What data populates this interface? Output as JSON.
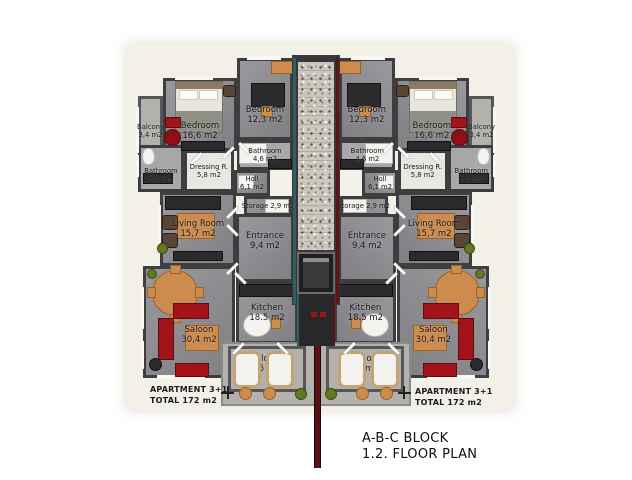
{
  "title_block": {
    "line1": "A-B-C BLOCK",
    "line2": "1.2. FLOOR PLAN"
  },
  "apartments": {
    "left": {
      "summary": {
        "line1": "APARTMENT 3+1",
        "line2": "TOTAL 172 m2"
      },
      "rooms": {
        "balcony_side": {
          "label": "Balcony",
          "area": "3,4 m2"
        },
        "bedroom_large": {
          "label": "Bedroom",
          "area": "16,6 m2"
        },
        "bedroom_small": {
          "label": "Bedroom",
          "area": "12,3 m2"
        },
        "bathroom_large": {
          "label": "Bathroom",
          "area": "5,2 m2"
        },
        "dressing": {
          "label": "Dressing R.",
          "area": "5,8 m2"
        },
        "bathroom_small": {
          "label": "Bathroom",
          "area": "4,6 m2"
        },
        "holl": {
          "label": "Holl",
          "area": "6,1 m2"
        },
        "storage": {
          "label": "Storage",
          "area": "2,9 m2"
        },
        "living_room": {
          "label": "Living Room",
          "area": "15,7 m2"
        },
        "entrance": {
          "label": "Entrance",
          "area": "9,4 m2"
        },
        "saloon": {
          "label": "Saloon",
          "area": "30,4 m2"
        },
        "kitchen": {
          "label": "Kitchen",
          "area": "18.5 m2"
        },
        "balcony_main": {
          "label": "Balcony",
          "area": "15 m2"
        }
      }
    },
    "right": {
      "summary": {
        "line1": "APARTMENT 3+1",
        "line2": "TOTAL 172 m2"
      },
      "rooms": {
        "balcony_side": {
          "label": "Balcony",
          "area": "3,4 m2"
        },
        "bedroom_large": {
          "label": "Bedroom",
          "area": "16,6 m2"
        },
        "bedroom_small": {
          "label": "Bedroom",
          "area": "12,3 m2"
        },
        "bathroom_large": {
          "label": "Bathroom",
          "area": "5,2 m2"
        },
        "dressing": {
          "label": "Dressing R.",
          "area": "5,8 m2"
        },
        "bathroom_small": {
          "label": "Bathroom",
          "area": "4,6 m2"
        },
        "holl": {
          "label": "Holl",
          "area": "6,1 m2"
        },
        "storage": {
          "label": "Storage",
          "area": "2,9 m2"
        },
        "living_room": {
          "label": "Living Room",
          "area": "15,7 m2"
        },
        "entrance": {
          "label": "Entrance",
          "area": "9,4 m2"
        },
        "saloon": {
          "label": "Saloon",
          "area": "30,4 m2"
        },
        "kitchen": {
          "label": "Kitchen",
          "area": "18.5 m2"
        },
        "balcony_main": {
          "label": "Balcony",
          "area": "15 m2"
        }
      }
    }
  },
  "colors": {
    "accent_teal": "#2e5f63",
    "accent_red": "#5c1516",
    "wall": "#3e3e40",
    "floor": "#8f8f93",
    "floor_light": "#b3b1ac",
    "furniture_red": "#a3141a",
    "wood": "#cd8b4e"
  }
}
